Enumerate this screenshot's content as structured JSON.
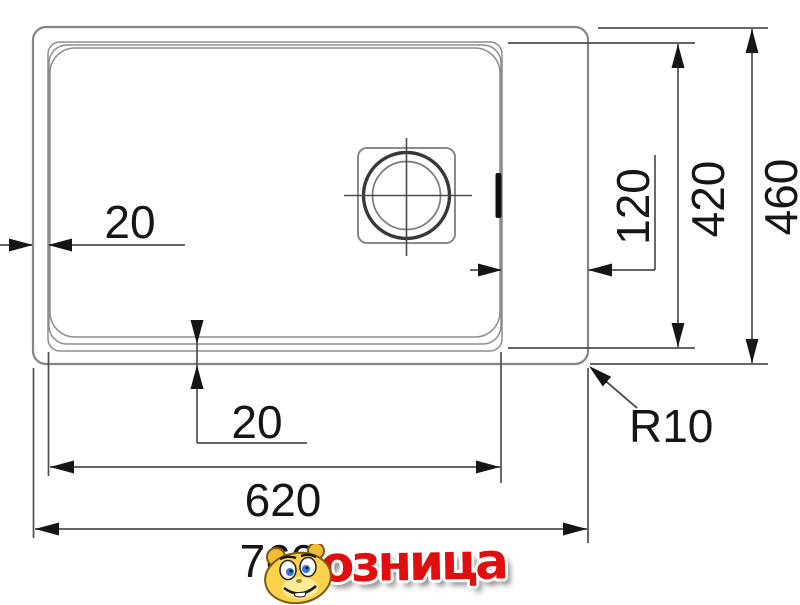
{
  "drawing": {
    "type": "sink-dimension-diagram",
    "dimensions": {
      "rim_left": "20",
      "rim_bottom": "20",
      "right_offset": "120",
      "bowl_depth": "420",
      "overall_depth": "460",
      "bowl_length": "620",
      "overall_length": "760",
      "corner_radius": "R10"
    }
  },
  "watermark": {
    "text": "озница",
    "mascot": "hamster-mascot-icon",
    "color": "#e00e0e"
  },
  "colors": {
    "outline_gray": "#8a8a8a",
    "dim_line": "#4f4f4f",
    "arrow_black": "#151515",
    "drain_dark": "#333333"
  }
}
